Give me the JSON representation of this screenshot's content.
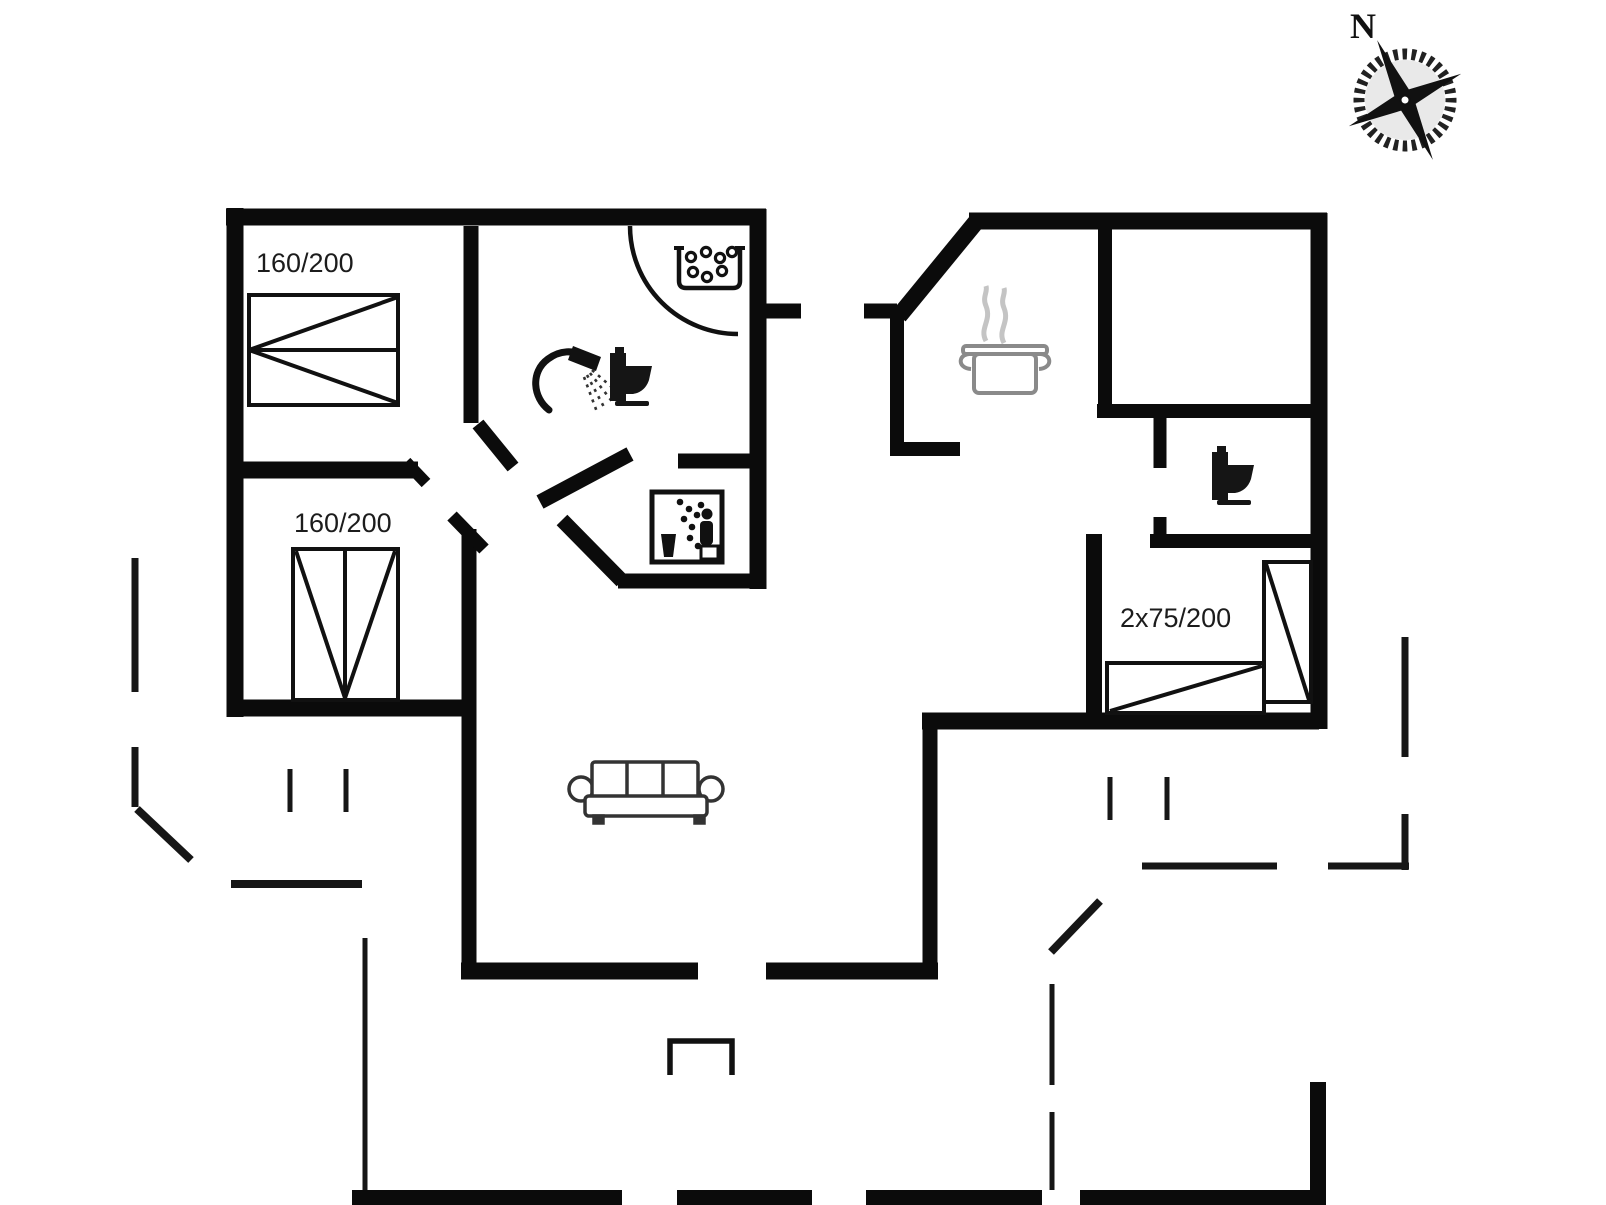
{
  "plan": {
    "title": "holiday-house-floor-plan",
    "labels": {
      "bed_top_left": "160/200",
      "bed_bottom_left": "160/200",
      "bed_right": "2x75/200"
    },
    "compass": {
      "north_label": "N"
    },
    "icons": {
      "bathroom": [
        "shower-icon",
        "toilet-icon",
        "washbasin-icon"
      ],
      "hall": [
        "sauna-icon"
      ],
      "kitchen": [
        "cooking-pot-icon",
        "steam-icon"
      ],
      "wc": [
        "toilet-icon"
      ],
      "living_room": [
        "sofa-icon"
      ],
      "site": [
        "compass-rose-icon",
        "terrace-dashed-boundary",
        "entrance-step"
      ]
    },
    "colors": {
      "background": "#ffffff",
      "wall": "#0b0b0b",
      "furniture_outline": "#111111",
      "pot_outline": "#8a8a8a",
      "steam": "#c4c4c4"
    }
  }
}
